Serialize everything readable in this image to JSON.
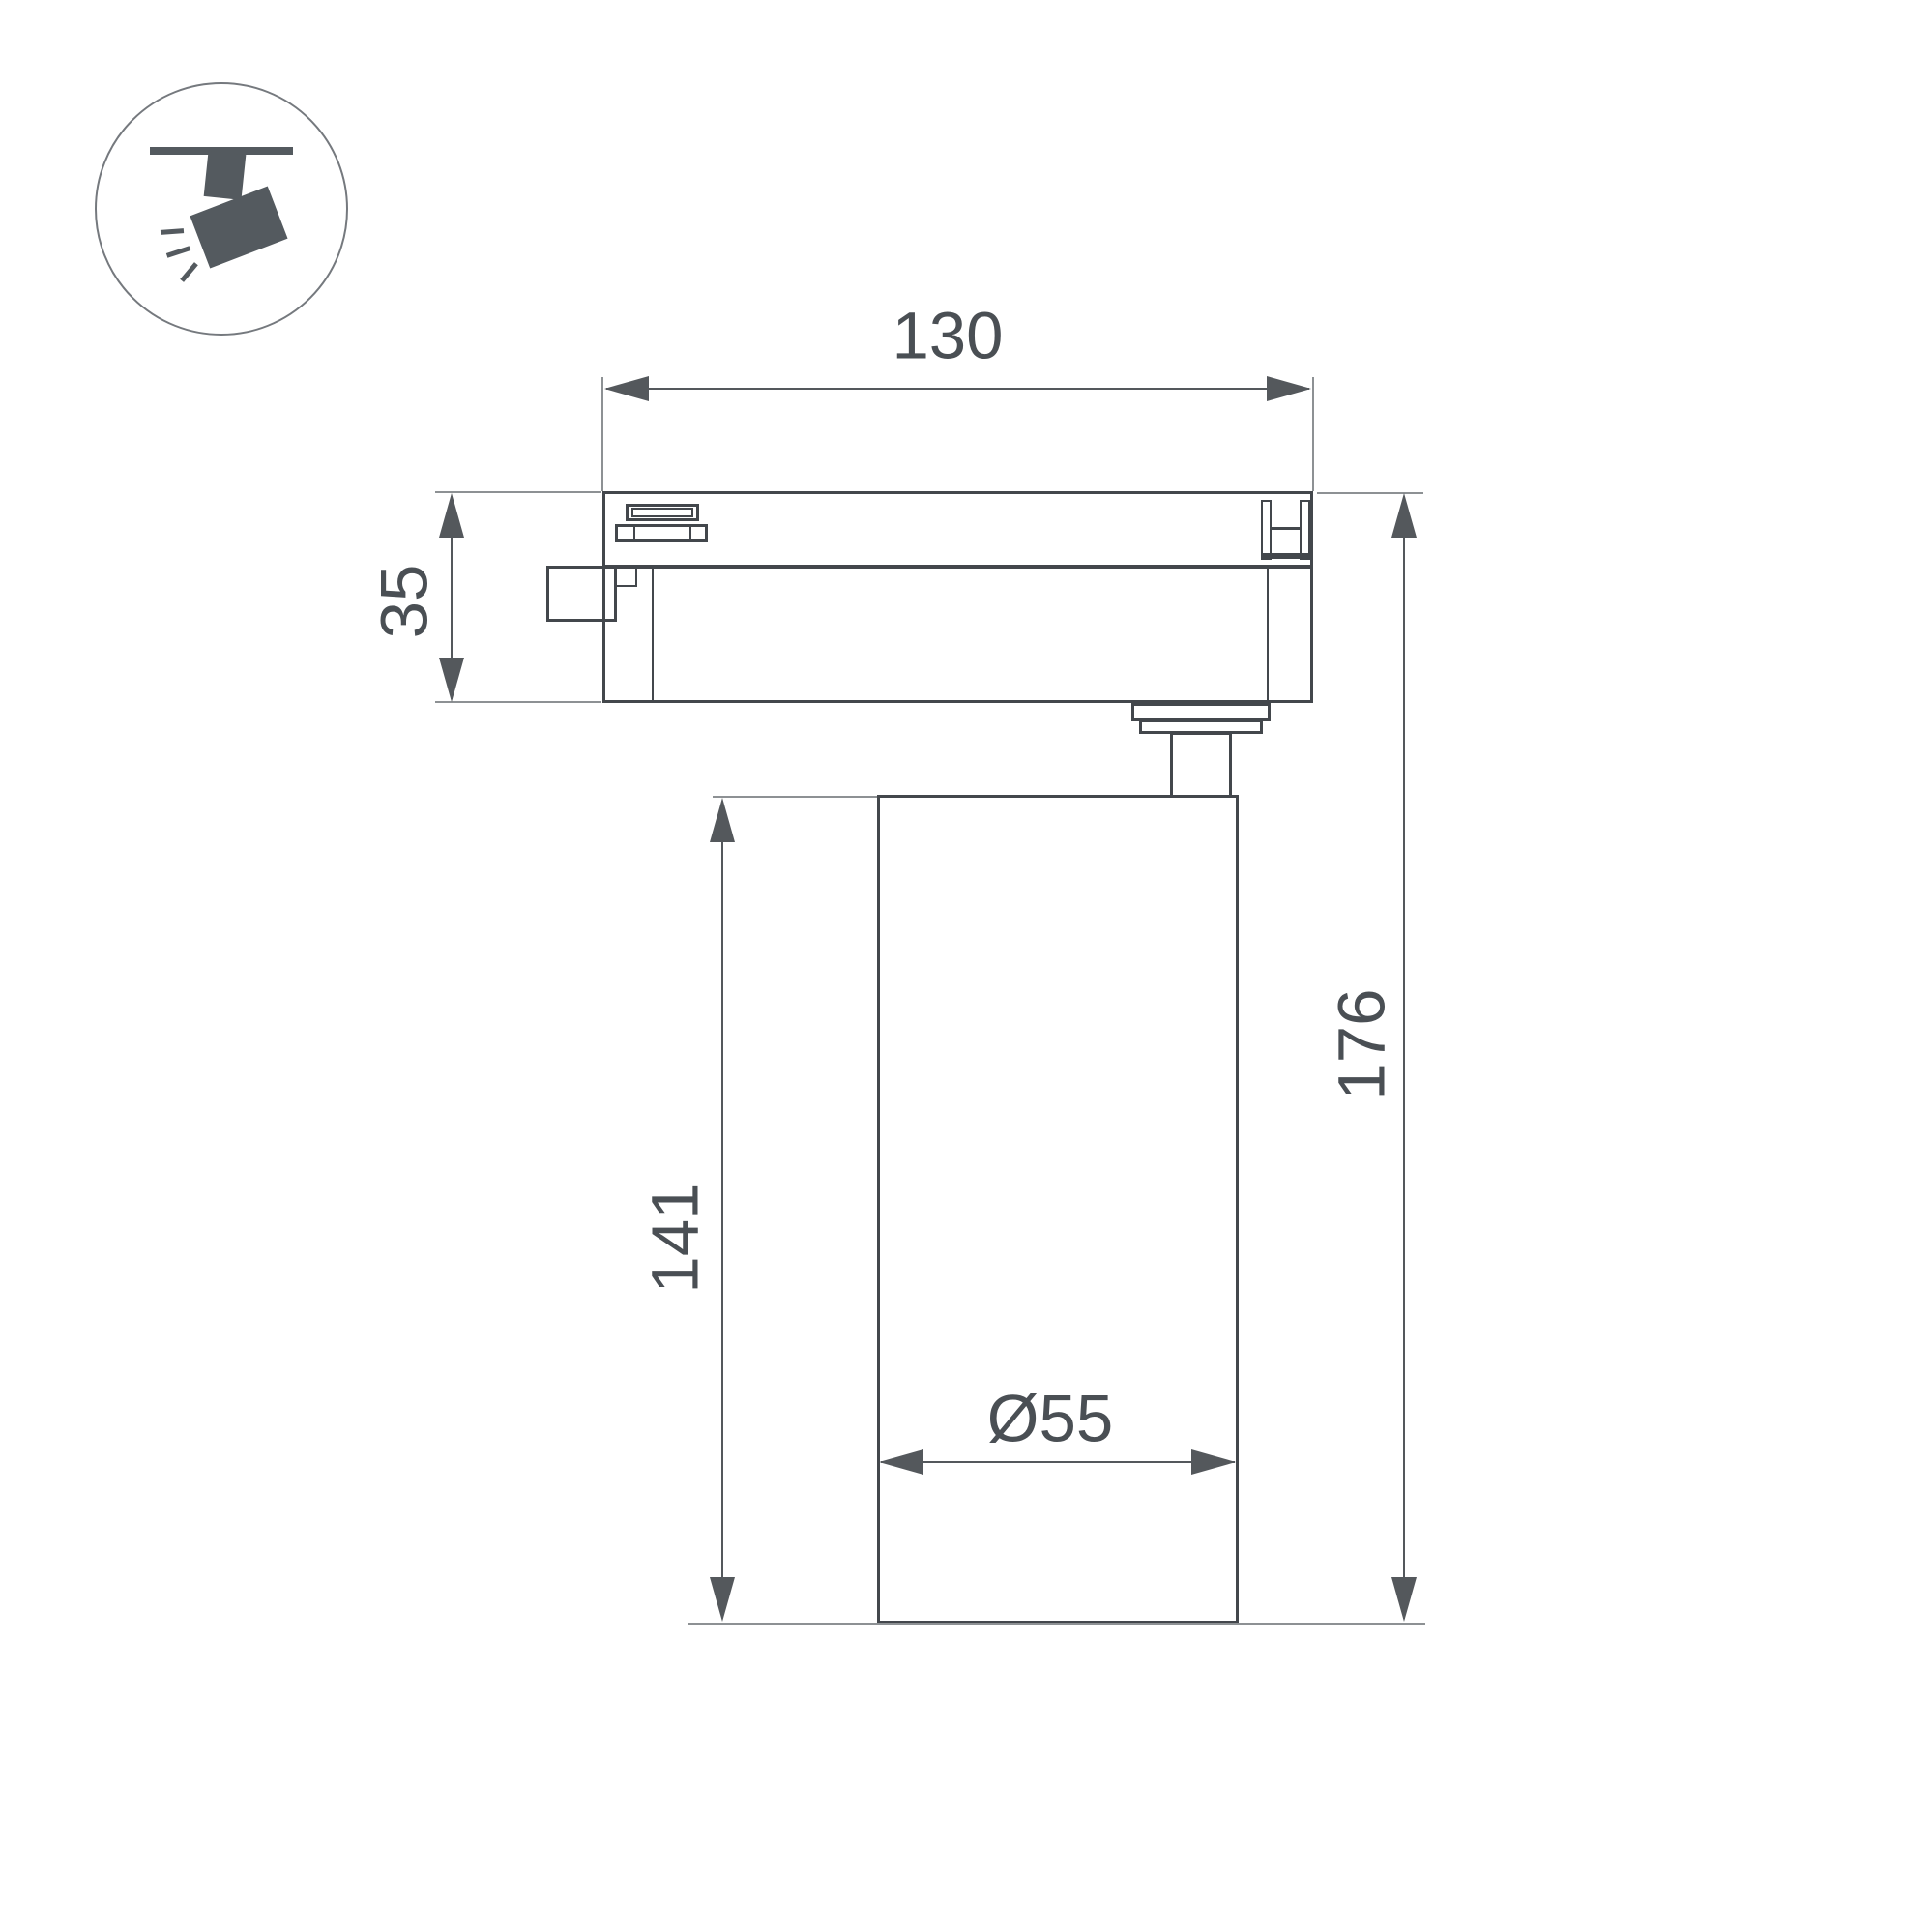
{
  "icon": {
    "name": "track-spotlight-icon"
  },
  "dimensions": {
    "track_adapter_length": {
      "label": "130"
    },
    "track_adapter_height": {
      "label": "35"
    },
    "lamp_body_height": {
      "label": "141"
    },
    "overall_height": {
      "label": "176"
    },
    "lamp_body_diameter": {
      "label": "Ø55"
    }
  },
  "colors": {
    "outline": "#43474c",
    "dimension_line": "#54585c",
    "extension_line": "#8d9194",
    "text": "#4a4f54",
    "icon_fill": "#545a5f",
    "background": "#ffffff"
  }
}
